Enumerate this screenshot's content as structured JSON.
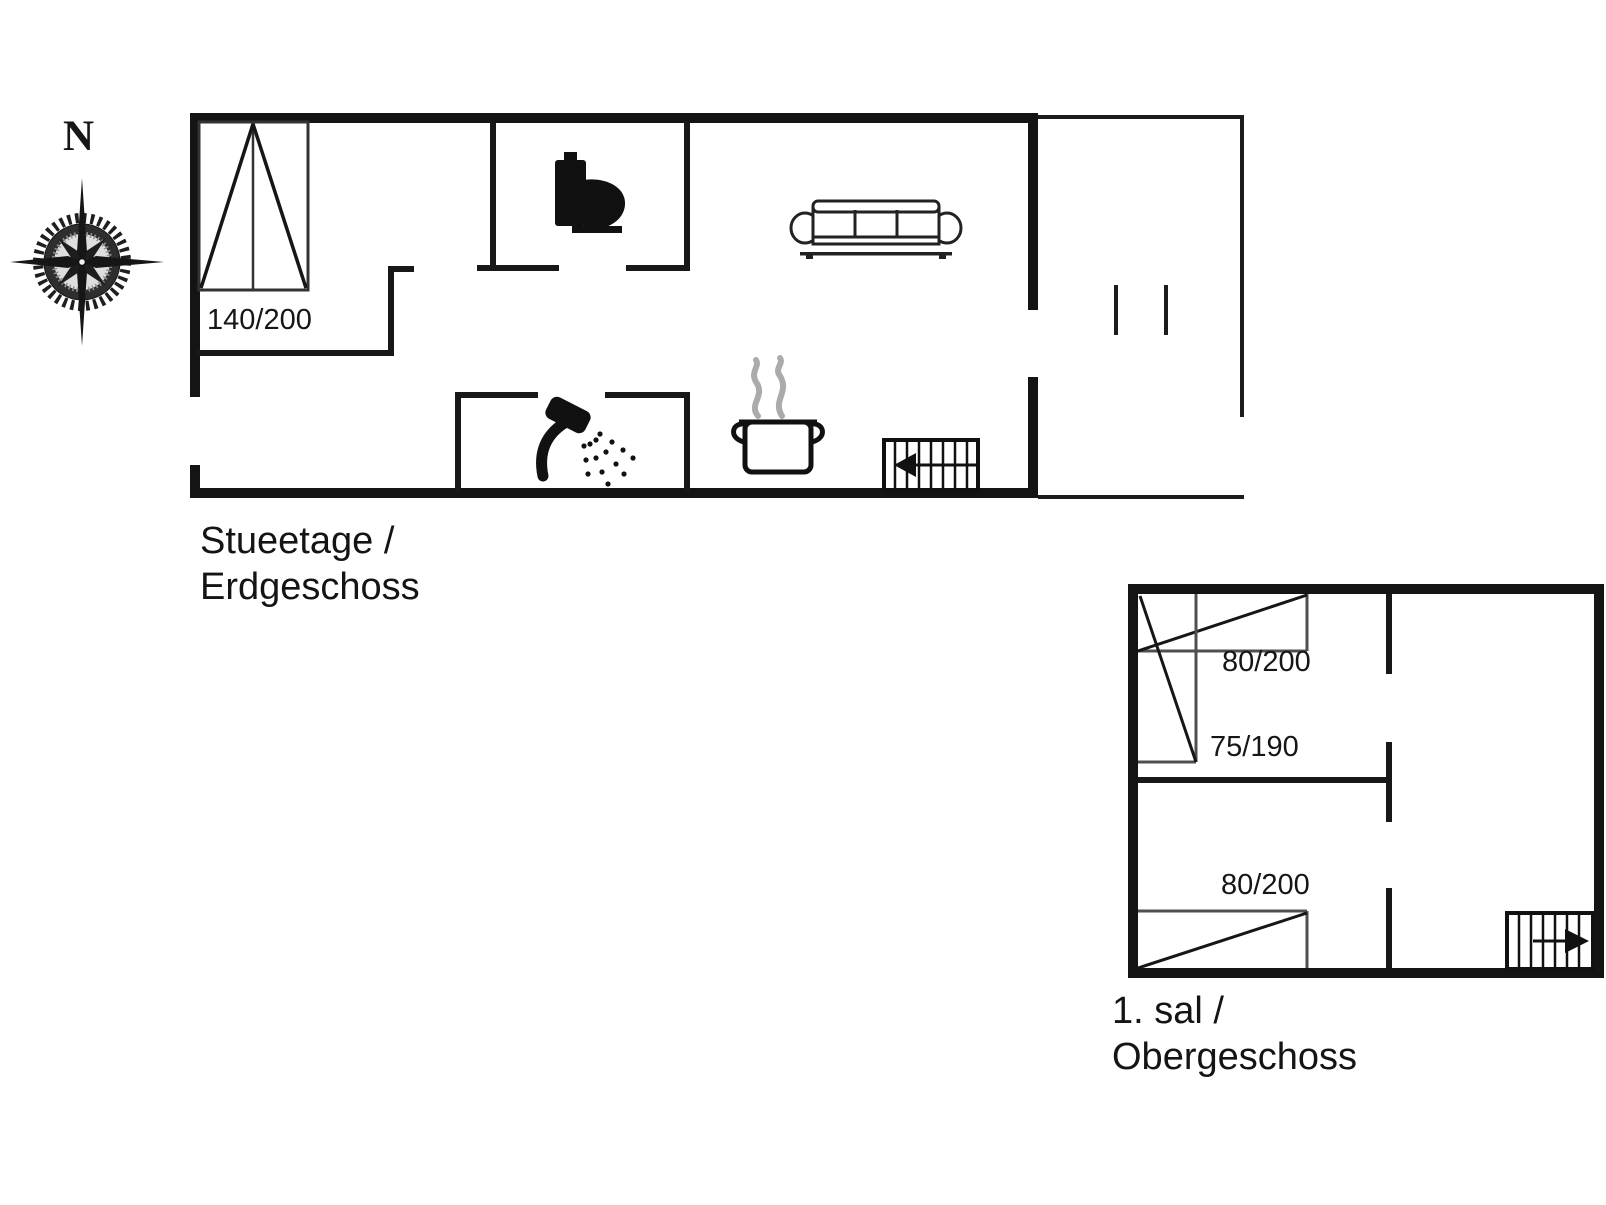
{
  "colors": {
    "ink": "#141414",
    "bed_edge": "#4f4f4f",
    "steam_gray": "#ababab",
    "background": "#ffffff"
  },
  "compass": {
    "label": "N",
    "icon": "compass-rose-icon"
  },
  "ground_floor": {
    "caption": {
      "line1": "Stueetage /",
      "line2": "Erdgeschoss"
    },
    "labels": {
      "double_bed": "140/200"
    },
    "icons": [
      "double-bed-icon",
      "toilet-icon",
      "shower-icon",
      "sofa-icon",
      "cooking-pot-icon",
      "steam-icon",
      "stairs-arrow-left-icon"
    ]
  },
  "upper_floor": {
    "caption": {
      "line1": "1. sal /",
      "line2": "Obergeschoss"
    },
    "labels": {
      "bed_top": "80/200",
      "bed_middle": "75/190",
      "bed_bottom": "80/200"
    },
    "icons": [
      "single-bed-icon",
      "single-bed-icon",
      "single-bed-icon",
      "stairs-arrow-right-icon"
    ]
  }
}
